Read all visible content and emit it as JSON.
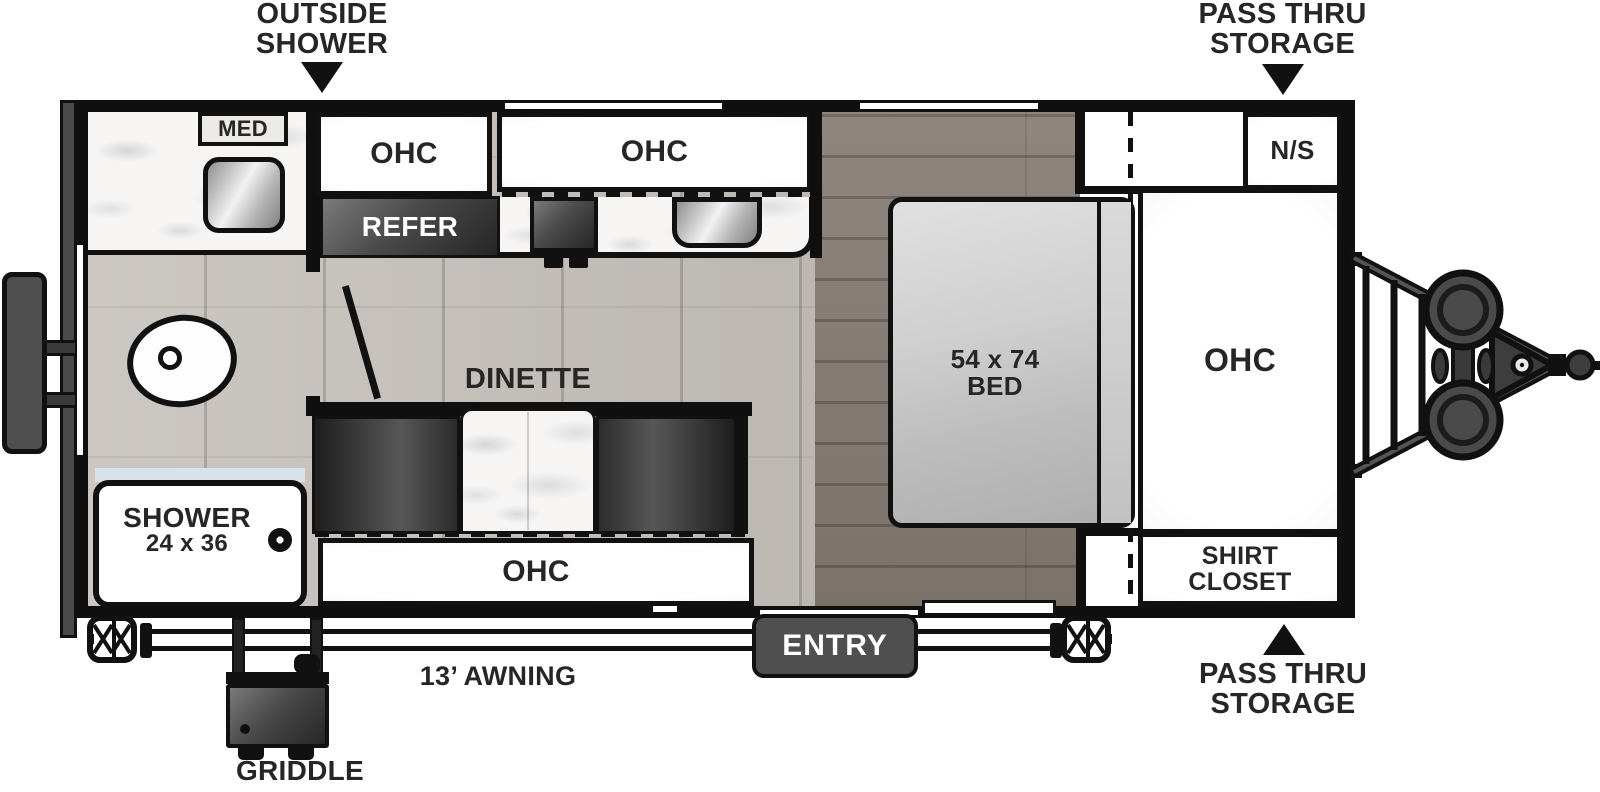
{
  "colors": {
    "wall": "#111111",
    "fixture_dark": "#3f3f3f",
    "entry_bg": "#4f4f4f",
    "floor_light": "#c6c1bb",
    "floor_dark": "#857c73",
    "label_text": "#262626",
    "marble": "#f6f5f4"
  },
  "icons": {
    "outside_shower_arrow": "triangle-down",
    "pass_thru_top_arrow": "triangle-down",
    "pass_thru_bottom_arrow": "triangle-up",
    "hitch": "trailer-tongue-with-propane-tanks",
    "stabilizer_jack": "scissor-jack",
    "rear_bumper": "bumper-with-rack",
    "griddle_unit": "slide-out-griddle",
    "toilet": "toilet-top-view",
    "sink": "sink-basin",
    "drain": "shower-drain"
  },
  "callouts": {
    "outside_shower": {
      "line1": "OUTSIDE",
      "line2": "SHOWER"
    },
    "pass_thru_top": {
      "line1": "PASS THRU",
      "line2": "STORAGE"
    },
    "pass_thru_bottom": {
      "line1": "PASS THRU",
      "line2": "STORAGE"
    },
    "awning": {
      "label": "13’ AWNING"
    },
    "griddle": {
      "label": "GRIDDLE"
    },
    "entry": {
      "label": "ENTRY"
    }
  },
  "bathroom": {
    "med": "MED",
    "shower_name": "SHOWER",
    "shower_size": "24 x 36"
  },
  "kitchen": {
    "ohc_small": "OHC",
    "ohc_wide": "OHC",
    "refer": "REFER"
  },
  "dinette": {
    "name": "DINETTE",
    "ohc": "OHC"
  },
  "bedroom": {
    "bed_size": "54 x 74",
    "bed_name": "BED",
    "nightstand": "N/S",
    "ohc": "OHC",
    "shirt_line1": "SHIRT",
    "shirt_line2": "CLOSET"
  }
}
